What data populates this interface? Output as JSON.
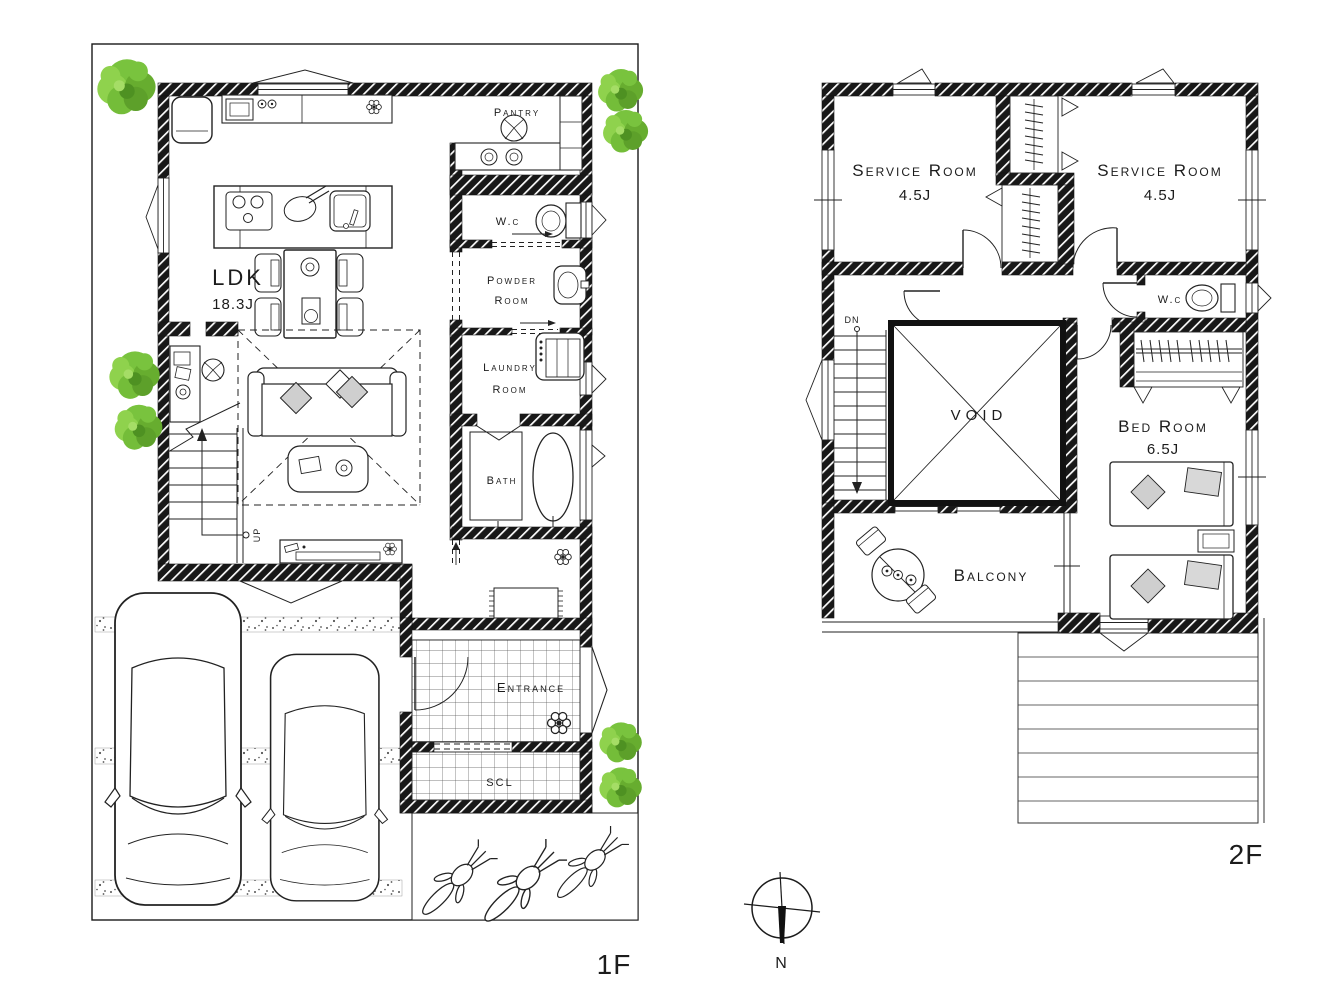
{
  "floor1": {
    "floor_label": "1F",
    "ldk": {
      "name": "LDK",
      "size": "18.3J"
    },
    "pantry": "Pantry",
    "wc": "W.c",
    "powder": [
      "Powder",
      "Room"
    ],
    "laundry": [
      "Laundry",
      "Room"
    ],
    "bath": "Bath",
    "entrance": "Entrance",
    "scl": "SCL",
    "stairs_up": "UP"
  },
  "floor2": {
    "floor_label": "2F",
    "service_rooms": [
      {
        "name": "Service Room",
        "size": "4.5J"
      },
      {
        "name": "Service Room",
        "size": "4.5J"
      }
    ],
    "wc": "W.c",
    "void": "VOID",
    "bedroom": {
      "name": "Bed Room",
      "size": "6.5J"
    },
    "balcony": "Balcony",
    "stairs_down": "DN"
  },
  "compass": {
    "north": "N"
  },
  "colors": {
    "wall": "#181818",
    "line": "#1c1c1c",
    "tree_light": "#8fd24d",
    "tree_mid": "#74bd39",
    "tree_dark": "#4e9122",
    "cushion": "#cfcfcf",
    "pillow": "#d8d8d8"
  }
}
